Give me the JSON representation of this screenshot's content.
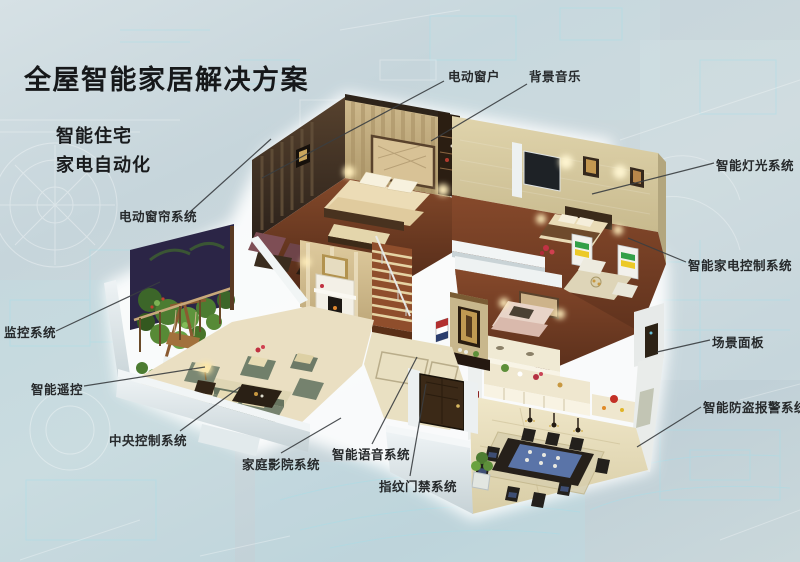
{
  "title": "全屋智能家居解决方案",
  "subtitle": {
    "line1": "智能住宅",
    "line2": "家电自动化"
  },
  "callouts": {
    "electric_window": "电动窗户",
    "background_music": "背景音乐",
    "smart_lighting": "智能灯光系统",
    "appliance_control": "智能家电控制系统",
    "scene_panel": "场景面板",
    "burglar_alarm": "智能防盗报警系统",
    "electric_curtain": "电动窗帘系统",
    "monitoring": "监控系统",
    "smart_remote": "智能遥控",
    "central_control": "中央控制系统",
    "home_theater": "家庭影院系统",
    "voice_system": "智能语音系统",
    "fingerprint_access": "指纹门禁系统"
  },
  "palette": {
    "background": "#c6d6dc",
    "blueprint_line": "#aee0ea",
    "label_text": "#26292b",
    "leader_line": "#3a3e41",
    "halo": "#ffffff",
    "dark_wood_floor": "#7c4427",
    "marble_floor": "#eadfc2",
    "white_wall": "#eef2f3",
    "gold_wall": "#cdb88c"
  }
}
